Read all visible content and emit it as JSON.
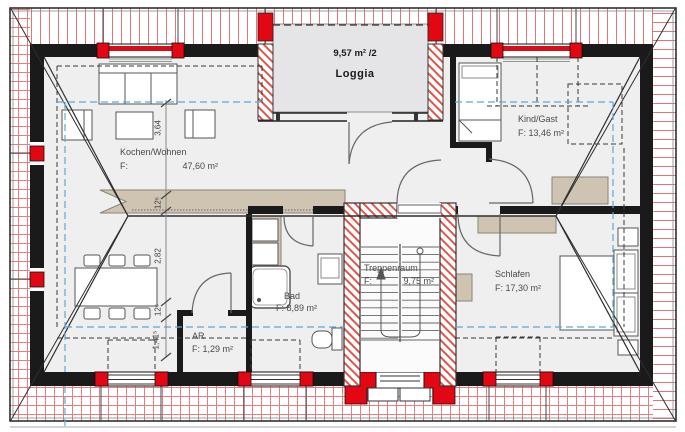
{
  "labels": {
    "loggia": {
      "area": "9,57 m² /2",
      "name": "Loggia"
    },
    "kochen_wohnen": {
      "name": "Kochen/Wohnen",
      "f": "F:",
      "area": "47,60 m²"
    },
    "kind_gast": {
      "name": "Kind/Gast",
      "area": "F: 13,46 m²"
    },
    "treppenraum": {
      "name": "Treppenraum",
      "f": "F:",
      "area": "9,75 m²"
    },
    "schlafen": {
      "name": "Schlafen",
      "area": "F: 17,30 m²"
    },
    "bad": {
      "name": "Bad",
      "area": "F: 8,89 m²"
    },
    "ar": {
      "name": "AR",
      "area": "F: 1,29 m²"
    }
  },
  "dimensions": [
    "3,64",
    "12⁶",
    "2,82",
    "12⁶",
    "1,41⁵"
  ],
  "colors": {
    "accent_red": "#e30613",
    "roof_hatch_red": "#d94848",
    "masonry_hatch_red": "#e0564a",
    "height_line_blue": "#5fa8d6",
    "furniture_tan": "#cfc4b2",
    "wall_dark": "#1a1a1a"
  }
}
